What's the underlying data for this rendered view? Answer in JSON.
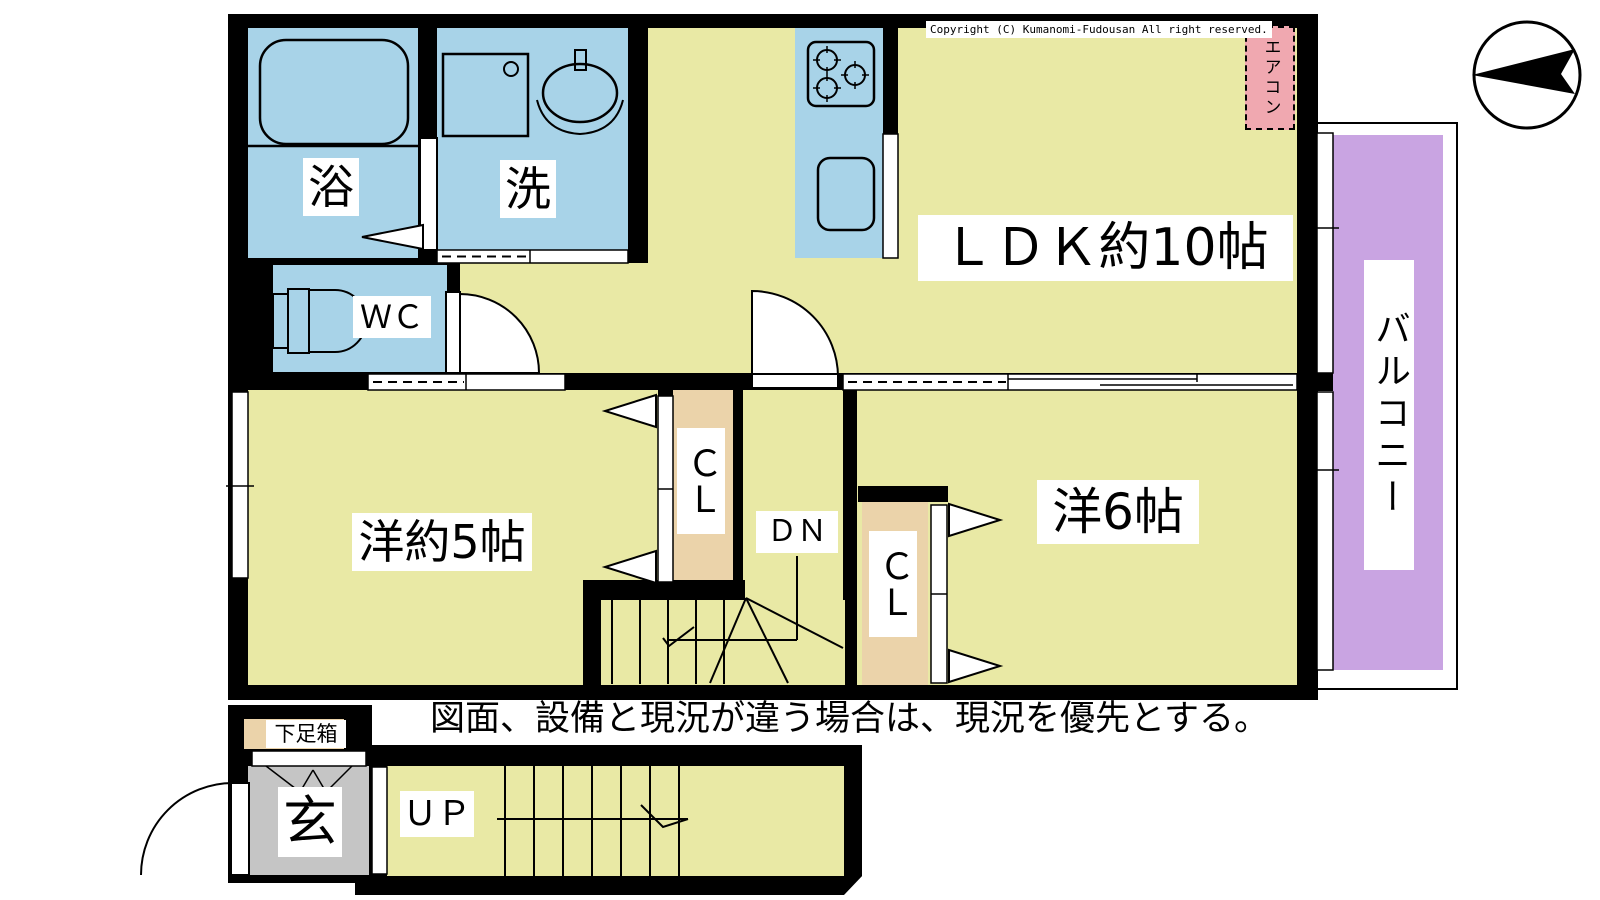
{
  "header": {
    "copyright": "Copyright (C) Kumanomi-Fudousan All right reserved."
  },
  "notice": "図面、設備と現況が違う場合は、現況を優先とする。",
  "rooms": {
    "ldk": "ＬＤＫ約10帖",
    "western_room_5": "洋約5帖",
    "western_room_6": "洋6帖",
    "bath": "浴",
    "washroom": "洗",
    "wc": "ＷＣ",
    "entrance": "玄",
    "balcony": "バルコニー"
  },
  "fixtures": {
    "air_conditioner": "エアコン",
    "closet_west5": "ＣＬ",
    "closet_west6": "ＣＬ",
    "shoe_box": "下足箱",
    "stairs_down": "ＤＮ",
    "stairs_up": "ＵＰ"
  },
  "icons": {
    "compass": "west-pointing-arrow-in-circle",
    "bathtub": "rounded-rect-tub",
    "washing_machine": "square-with-dial",
    "wash_basin": "oval-basin-with-faucet",
    "toilet": "side-view-toilet",
    "stove": "three-burner-stove",
    "kitchen_sink": "rounded-rect-sink",
    "doors": "quarter-circle-swing-and-sliding",
    "stairs": "tread-lines-with-direction-arrow"
  },
  "colors": {
    "floor": "#e9e9a5",
    "wet_area": "#a8d3e8",
    "closet": "#ebd3aa",
    "balcony": "#c9a4e2",
    "aircon_box": "#f0a8b0",
    "entrance_floor": "#c5c5c5",
    "wall": "#000000"
  }
}
